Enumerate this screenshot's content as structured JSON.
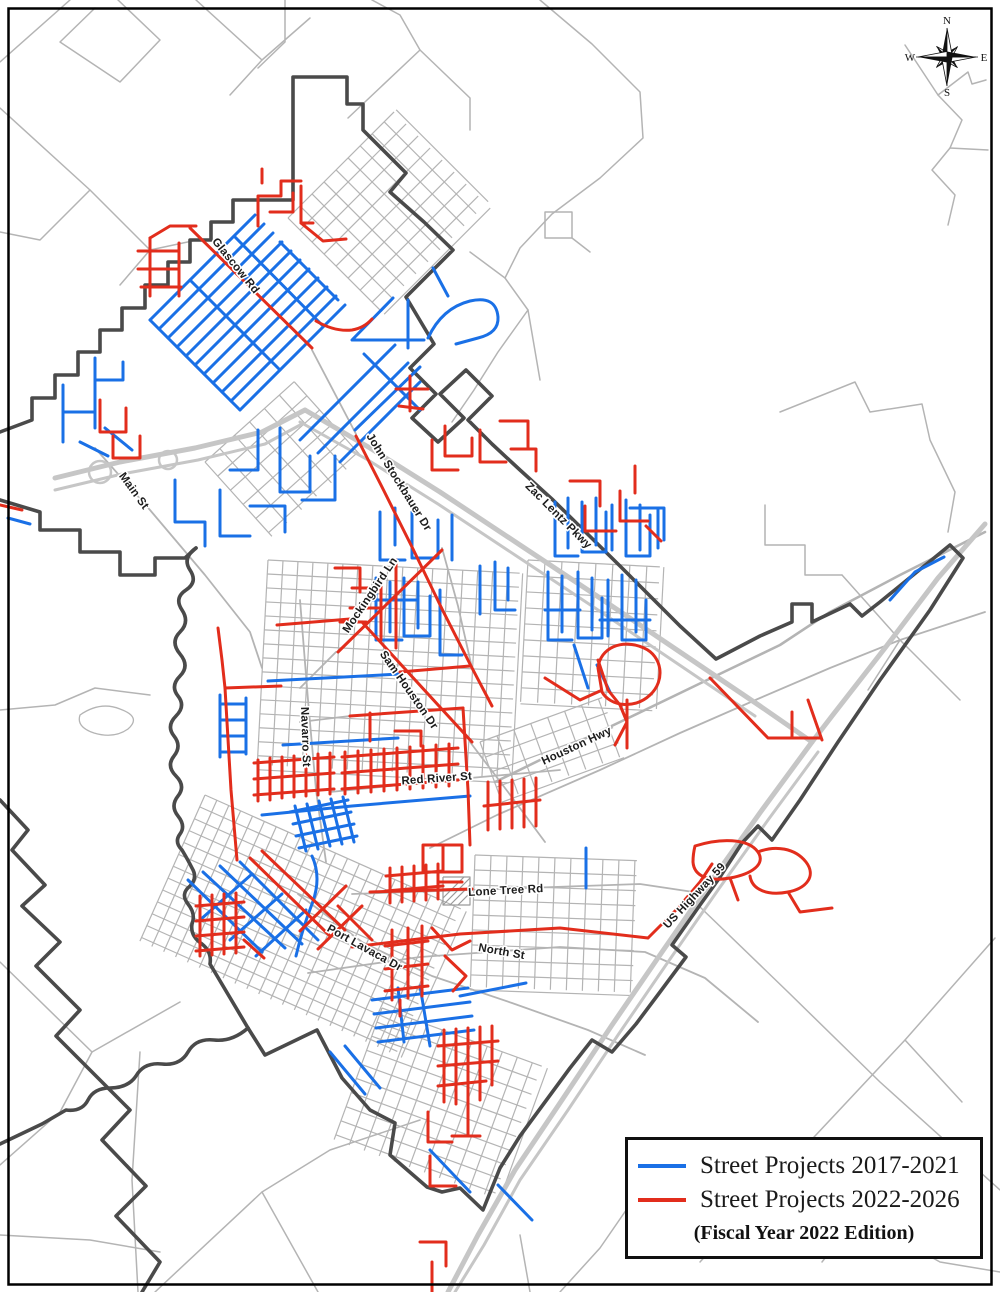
{
  "map": {
    "street_labels": [
      {
        "text": "Glascow Rd"
      },
      {
        "text": "Main St"
      },
      {
        "text": "John Stockbauer Dr"
      },
      {
        "text": "Zac Lentz Pkwy"
      },
      {
        "text": "Mockingbird Ln"
      },
      {
        "text": "Sam Houston Dr"
      },
      {
        "text": "Navarro St"
      },
      {
        "text": "Houston Hwy"
      },
      {
        "text": "Red River St"
      },
      {
        "text": "Lone Tree Rd"
      },
      {
        "text": "US Highway 59"
      },
      {
        "text": "North St"
      },
      {
        "text": "Port Lavaca Dr"
      }
    ],
    "compass": {
      "n": "N",
      "e": "E",
      "s": "S",
      "w": "W"
    },
    "legend": {
      "items": [
        {
          "label": "Street Projects 2017-2021",
          "color": "#1a70e6"
        },
        {
          "label": "Street Projects 2022-2026",
          "color": "#e22d1c"
        }
      ],
      "footnote": "(Fiscal Year 2022 Edition)"
    },
    "colors": {
      "projects_2017_2021": "#1a70e6",
      "projects_2022_2026": "#e22d1c",
      "city_boundary": "#4a4a4a",
      "roads": "#b4b4b4",
      "highways": "#c6c6c6",
      "frame": "#000000",
      "background": "#ffffff"
    }
  }
}
